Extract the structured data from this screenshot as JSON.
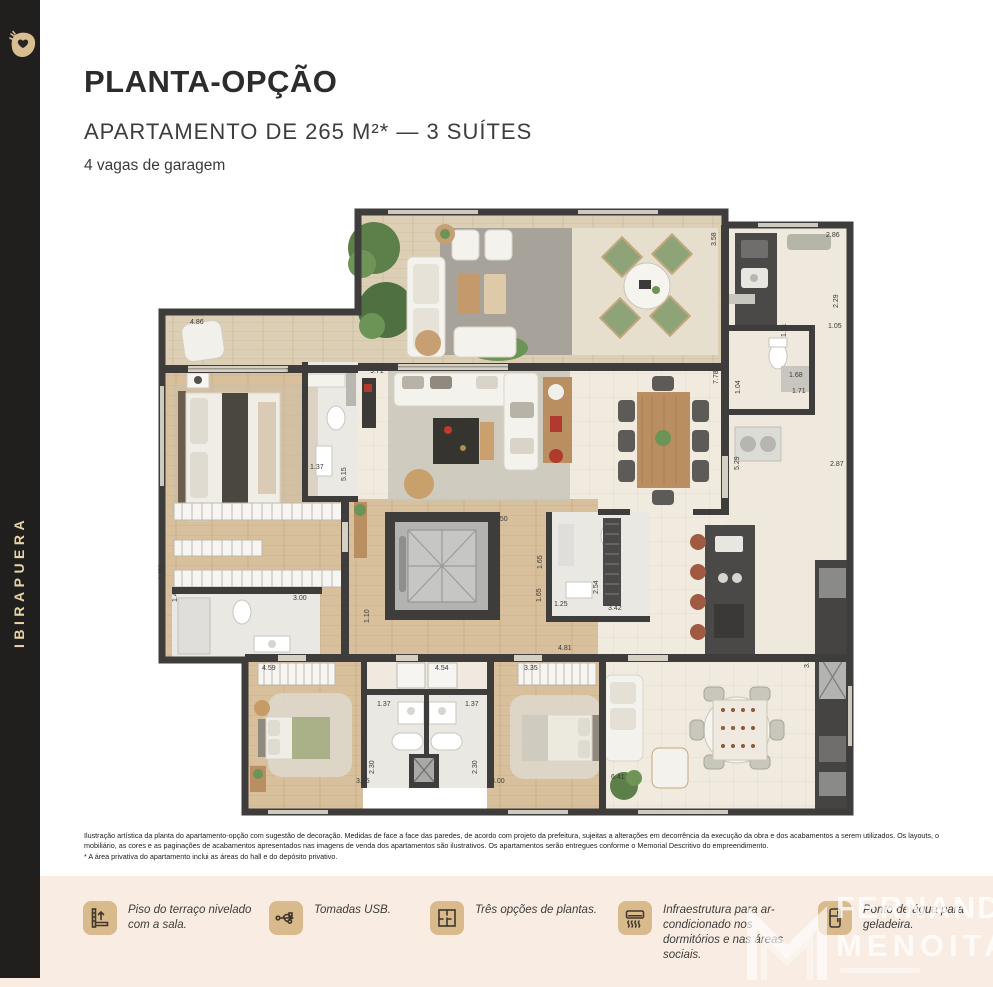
{
  "palette": {
    "accent_tan": "#d9ba8d",
    "sidebar_bg": "#211f1e",
    "sidebar_text": "#e7d3a9",
    "band_bg": "#f9ece2",
    "wall": "#3e3d3b",
    "wood_floor": "#d8c09c",
    "cream_floor": "#f1ebdf",
    "plant_green": "#6d9457",
    "title_color": "#2d2c2a"
  },
  "sidebar": {
    "label": "IBIRAPUERA"
  },
  "header": {
    "title": "PLANTA-OPÇÃO",
    "subtitle": "APARTAMENTO DE 265 M²* — 3 SUÍTES",
    "garage": "4 vagas de garagem"
  },
  "disclaimer": {
    "line1": "Ilustração artística da planta do apartamento-opção com sugestão de decoração. Medidas de face a face das paredes, de acordo com projeto da prefeitura, sujeitas a alterações em decorrência da execução da obra e dos acabamentos a serem utilizados. Os layouts, o",
    "line2": "mobiliário, as cores e as paginações de acabamentos apresentados nas imagens de venda dos apartamentos são ilustrativos. Os apartamentos serão entregues conforme o Memorial Descritivo do empreendimento.",
    "line3": "* A área privativa do apartamento inclui as áreas do hall e do depósito privativo."
  },
  "features": [
    {
      "icon": "terrace-level-icon",
      "label": "Piso do terraço nivelado com a sala."
    },
    {
      "icon": "usb-icon",
      "label": "Tomadas USB."
    },
    {
      "icon": "floorplan-options-icon",
      "label": "Três opções de plantas."
    },
    {
      "icon": "air-conditioner-icon",
      "label": "Infraestrutura para ar-condicionado nos dormitórios e nas áreas sociais."
    },
    {
      "icon": "refrigerator-icon",
      "label": "Ponto de água para geladeira."
    }
  ],
  "watermark": {
    "line1": "FERNANDO",
    "line2": "MENOITA"
  },
  "floorplan": {
    "dimensions": [
      {
        "t": "4.86",
        "x": 32,
        "y": 118
      },
      {
        "t": "3.42",
        "x": 128,
        "y": 167
      },
      {
        "t": "2.45",
        "x": 150,
        "y": 192,
        "r": 1
      },
      {
        "t": "9.71",
        "x": 212,
        "y": 167
      },
      {
        "t": "1.37",
        "x": 152,
        "y": 263
      },
      {
        "t": "5.15",
        "x": 188,
        "y": 275,
        "r": 1
      },
      {
        "t": "3.58",
        "x": 558,
        "y": 40,
        "r": 1
      },
      {
        "t": "2.86",
        "x": 668,
        "y": 31
      },
      {
        "t": "2.29",
        "x": 680,
        "y": 102,
        "r": 1
      },
      {
        "t": "1.05",
        "x": 670,
        "y": 122
      },
      {
        "t": "1.51",
        "x": 628,
        "y": 131,
        "r": 1
      },
      {
        "t": "1.68",
        "x": 631,
        "y": 171
      },
      {
        "t": "1.71",
        "x": 634,
        "y": 187
      },
      {
        "t": "7.78",
        "x": 560,
        "y": 178,
        "r": 1
      },
      {
        "t": "1.04",
        "x": 582,
        "y": 188,
        "r": 1
      },
      {
        "t": "5.29",
        "x": 581,
        "y": 264,
        "r": 1
      },
      {
        "t": "2.87",
        "x": 672,
        "y": 260
      },
      {
        "t": "1.50",
        "x": 336,
        "y": 315
      },
      {
        "t": "1.65",
        "x": 384,
        "y": 363,
        "r": 1
      },
      {
        "t": "1.65",
        "x": 383,
        "y": 396,
        "r": 1
      },
      {
        "t": "1.25",
        "x": 396,
        "y": 400
      },
      {
        "t": "3.00",
        "x": 135,
        "y": 394
      },
      {
        "t": "1.41",
        "x": 19,
        "y": 396,
        "r": 1
      },
      {
        "t": "5.93",
        "x": 4,
        "y": 373,
        "r": 1
      },
      {
        "t": "1.10",
        "x": 211,
        "y": 417,
        "r": 1
      },
      {
        "t": "4.81",
        "x": 400,
        "y": 444
      },
      {
        "t": "4.59",
        "x": 104,
        "y": 464
      },
      {
        "t": "4.54",
        "x": 277,
        "y": 464
      },
      {
        "t": "3.35",
        "x": 366,
        "y": 464
      },
      {
        "t": "1.37",
        "x": 219,
        "y": 500
      },
      {
        "t": "1.37",
        "x": 307,
        "y": 500
      },
      {
        "t": "2.30",
        "x": 216,
        "y": 568,
        "r": 1
      },
      {
        "t": "2.30",
        "x": 319,
        "y": 568,
        "r": 1
      },
      {
        "t": "3.05",
        "x": 198,
        "y": 577
      },
      {
        "t": "3.00",
        "x": 333,
        "y": 577
      },
      {
        "t": "2.54",
        "x": 440,
        "y": 388,
        "r": 1
      },
      {
        "t": "3.42",
        "x": 450,
        "y": 404
      },
      {
        "t": "3.31",
        "x": 651,
        "y": 462,
        "r": 1
      },
      {
        "t": "6.41",
        "x": 453,
        "y": 573
      }
    ]
  }
}
